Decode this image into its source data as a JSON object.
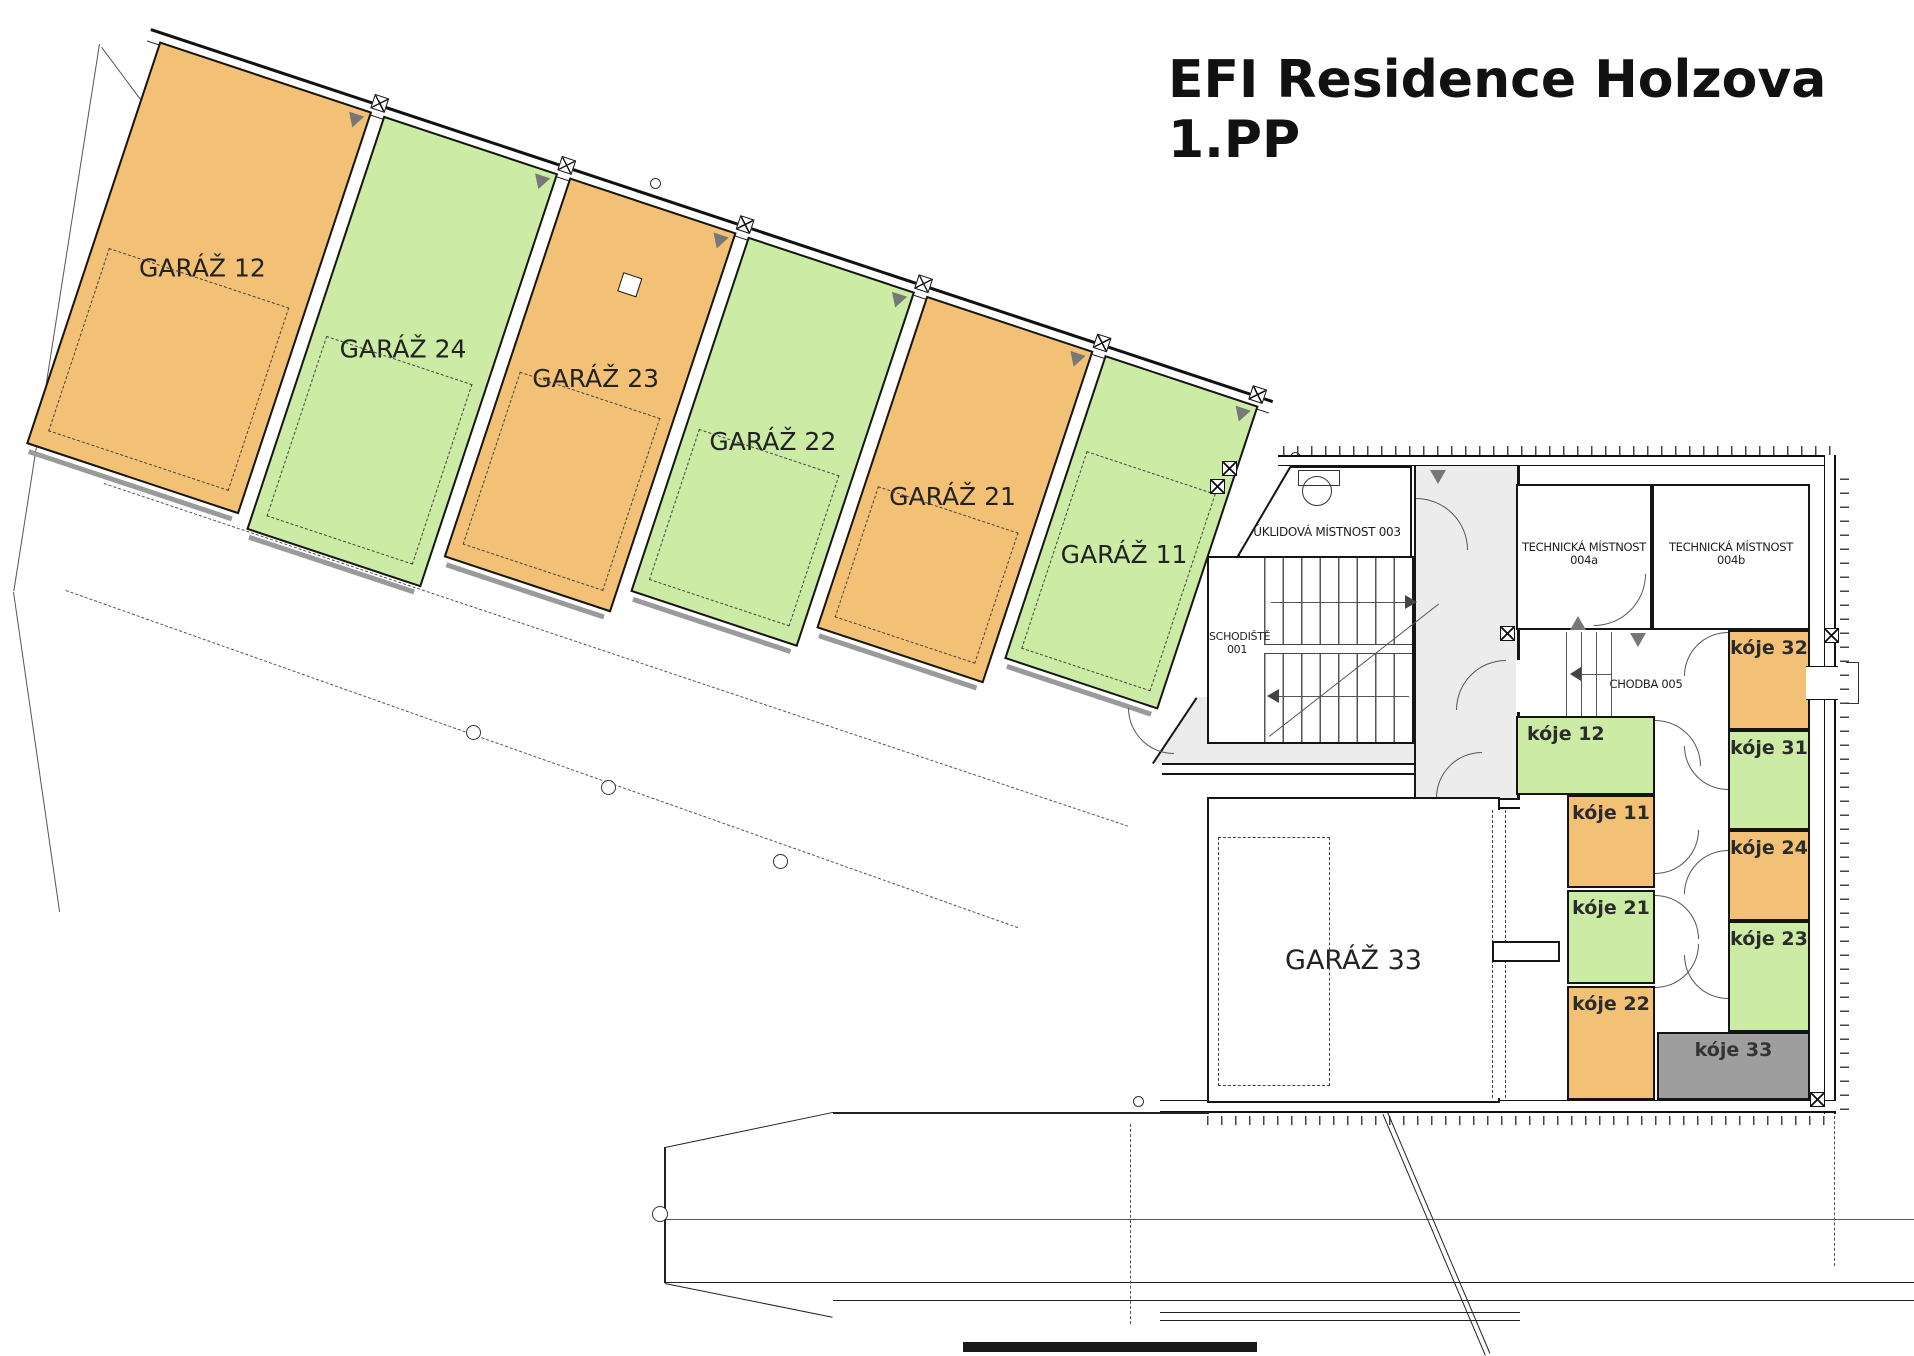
{
  "title": {
    "line1": "EFI Residence Holzova",
    "line2": "1.PP"
  },
  "colors": {
    "orange": "#F2C175",
    "green": "#CCEBA4",
    "unit_gray": "#9E9E9E",
    "corridor_gray": "#ECECEC"
  },
  "garages": {
    "strip": [
      {
        "label": "GARÁŽ 12",
        "color": "orange"
      },
      {
        "label": "GARÁŽ 24",
        "color": "green"
      },
      {
        "label": "GARÁŽ 23",
        "color": "orange"
      },
      {
        "label": "GARÁŽ 22",
        "color": "green"
      },
      {
        "label": "GARÁŽ 21",
        "color": "orange"
      },
      {
        "label": "GARÁŽ 11",
        "color": "green"
      }
    ],
    "garage33": {
      "label": "GARÁŽ  33"
    }
  },
  "rooms": {
    "uklidova": {
      "label": "ÚKLIDOVÁ MÍSTNOST 003"
    },
    "schodiste": {
      "line1": "SCHODIŠTĚ",
      "line2": "001"
    },
    "chodba002": {
      "label": "CHODBA 002"
    },
    "tech004a": {
      "line1": "TECHNICKÁ MÍSTNOST",
      "line2": "004a"
    },
    "tech004b": {
      "line1": "TECHNICKÁ MÍSTNOST",
      "line2": "004b"
    },
    "chodba005": {
      "label": "CHODBA 005"
    }
  },
  "koje": {
    "left": [
      {
        "label": "kóje 12",
        "color": "green"
      },
      {
        "label": "kóje 11",
        "color": "orange"
      },
      {
        "label": "kóje 21",
        "color": "green"
      },
      {
        "label": "kóje 22",
        "color": "orange"
      }
    ],
    "right": [
      {
        "label": "kóje 32",
        "color": "orange"
      },
      {
        "label": "kóje 31",
        "color": "green"
      },
      {
        "label": "kóje 24",
        "color": "orange"
      },
      {
        "label": "kóje 23",
        "color": "green"
      },
      {
        "label": "kóje 33",
        "color": "unit_gray"
      }
    ]
  }
}
